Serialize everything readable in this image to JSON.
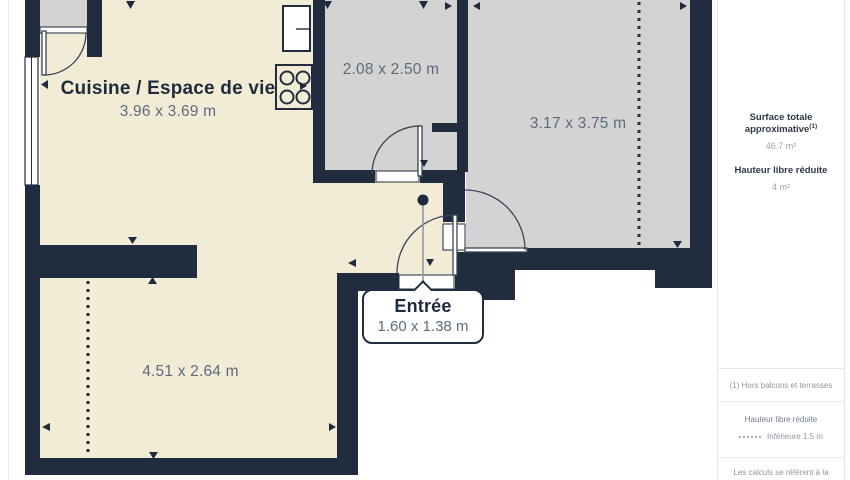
{
  "colors": {
    "wall": "#212c3e",
    "room_warm": "#f2ecd7",
    "room_gray": "#d3d3d4",
    "dimension_text": "#5d6b7c",
    "label_text": "#1f2b3d"
  },
  "rooms": {
    "kitchen": {
      "label": "Cuisine / Espace de vie",
      "dims": "3.96 x 3.69 m"
    },
    "top": {
      "dims": "2.08 x 2.50 m"
    },
    "right": {
      "dims": "3.17 x 3.75 m"
    },
    "bottom": {
      "dims": "4.51 x 2.64 m"
    },
    "entry": {
      "label": "Entrée",
      "dims": "1.60 x 1.38 m"
    }
  },
  "sidebar": {
    "surface": {
      "title": "Surface totale approximative",
      "note_ref": "(1)",
      "value": "46.7 m²"
    },
    "reduced_height": {
      "title": "Hauteur libre réduite",
      "value": "4 m²"
    },
    "footnote": "(1) Hors balcons et terrasses",
    "legend": {
      "title": "Hauteur libre réduite",
      "item": "Inférieure 1.5 m"
    },
    "disclaimer": "Les calculs se réfèrent à la norme RICS IPMS 3C. Toutes les mesures sont"
  }
}
